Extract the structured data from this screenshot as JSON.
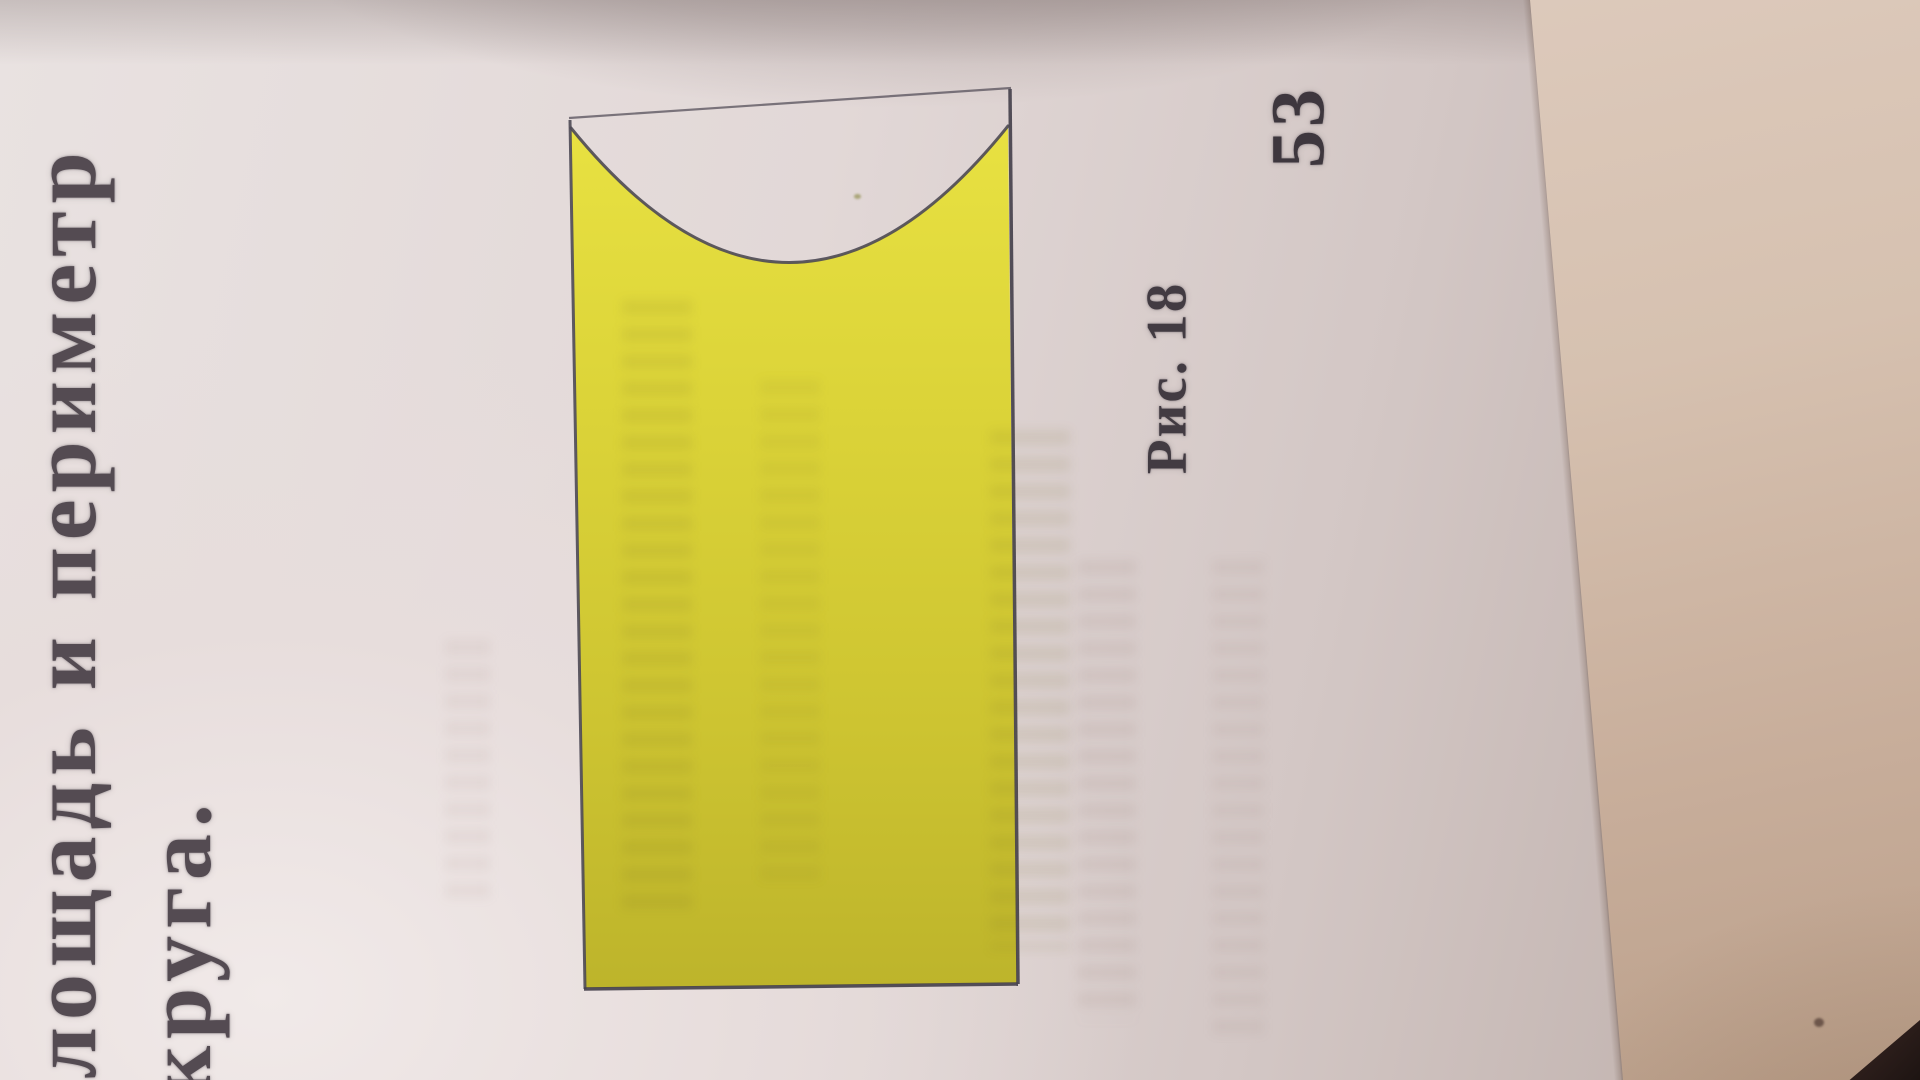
{
  "page": {
    "heading_line1": "лощадь и периметр",
    "heading_line2": "круга.",
    "figure_caption": "Рис. 18",
    "page_number": "53"
  },
  "figure": {
    "shape": "rectangle with a concave semicircular notch cut into its top edge (photo rotated 90°)",
    "fill_color": "#d9d135",
    "outline_color": "#4d4954",
    "chord_line": "thin straight line joining the two top corners above the notch"
  },
  "photo": {
    "paper_color": "#e2d8d7",
    "book_edge_color": "#c8ae9b",
    "shadow_color": "#584846",
    "corner_object_colors": [
      "#7c342e",
      "#1d1412"
    ]
  }
}
